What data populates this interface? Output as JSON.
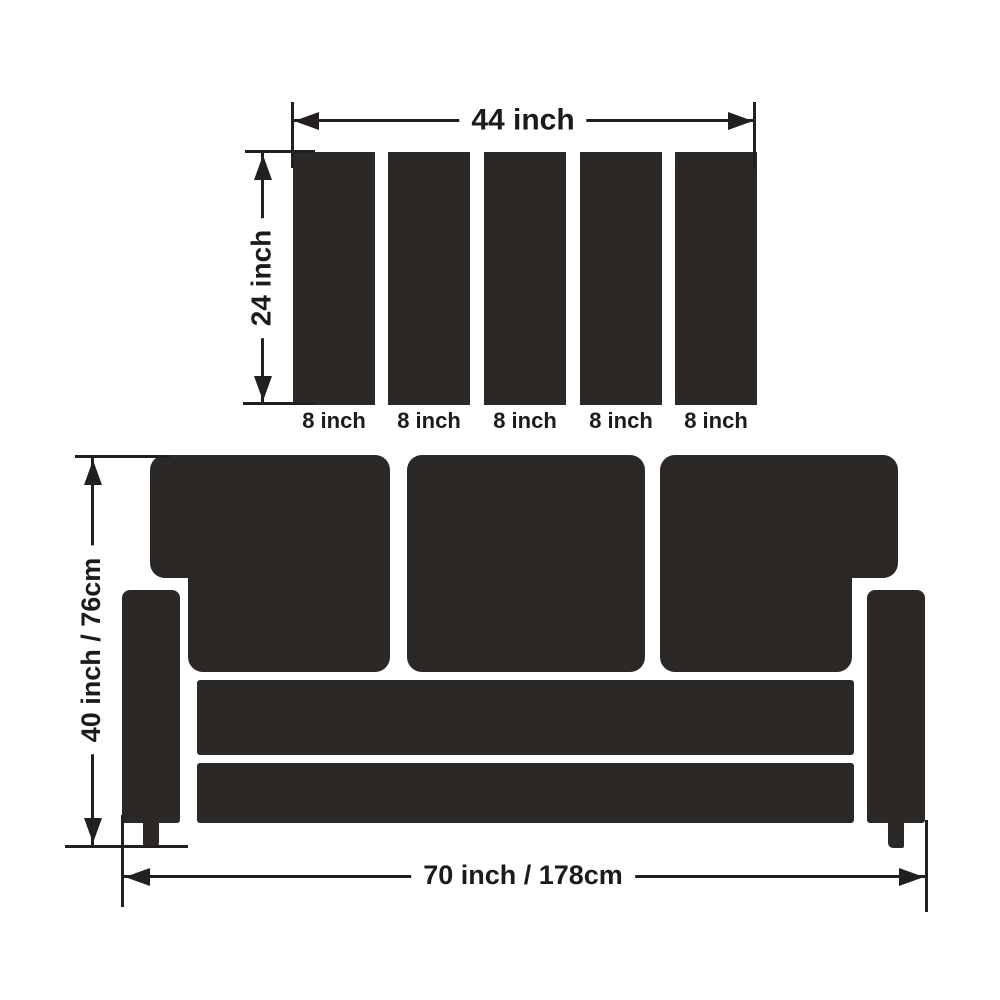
{
  "diagram": {
    "colors": {
      "background": "#ffffff",
      "shape": "#2b2826",
      "line": "#231f20",
      "text": "#1d1a1a"
    },
    "top_view": {
      "width_label": "44 inch",
      "depth_label": "24 inch",
      "slat_labels": [
        "8 inch",
        "8 inch",
        "8 inch",
        "8 inch",
        "8 inch"
      ]
    },
    "front_view": {
      "height_label": "40 inch / 76cm",
      "width_label": "70 inch / 178cm"
    }
  }
}
